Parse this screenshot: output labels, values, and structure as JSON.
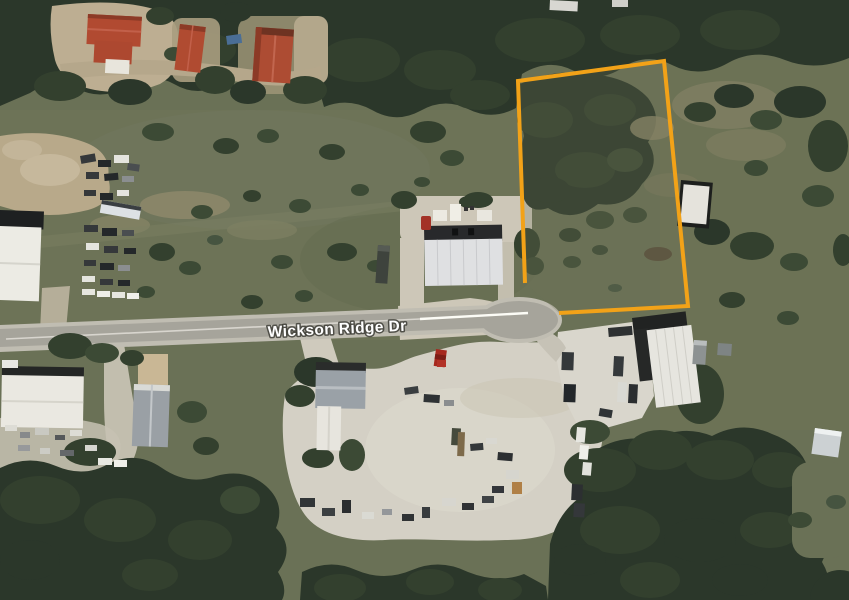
{
  "map": {
    "view": "satellite",
    "road_label": "Wickson Ridge Dr",
    "road_label_color": "#FFFFFF",
    "parcel_outline_color": "#F2A218"
  }
}
